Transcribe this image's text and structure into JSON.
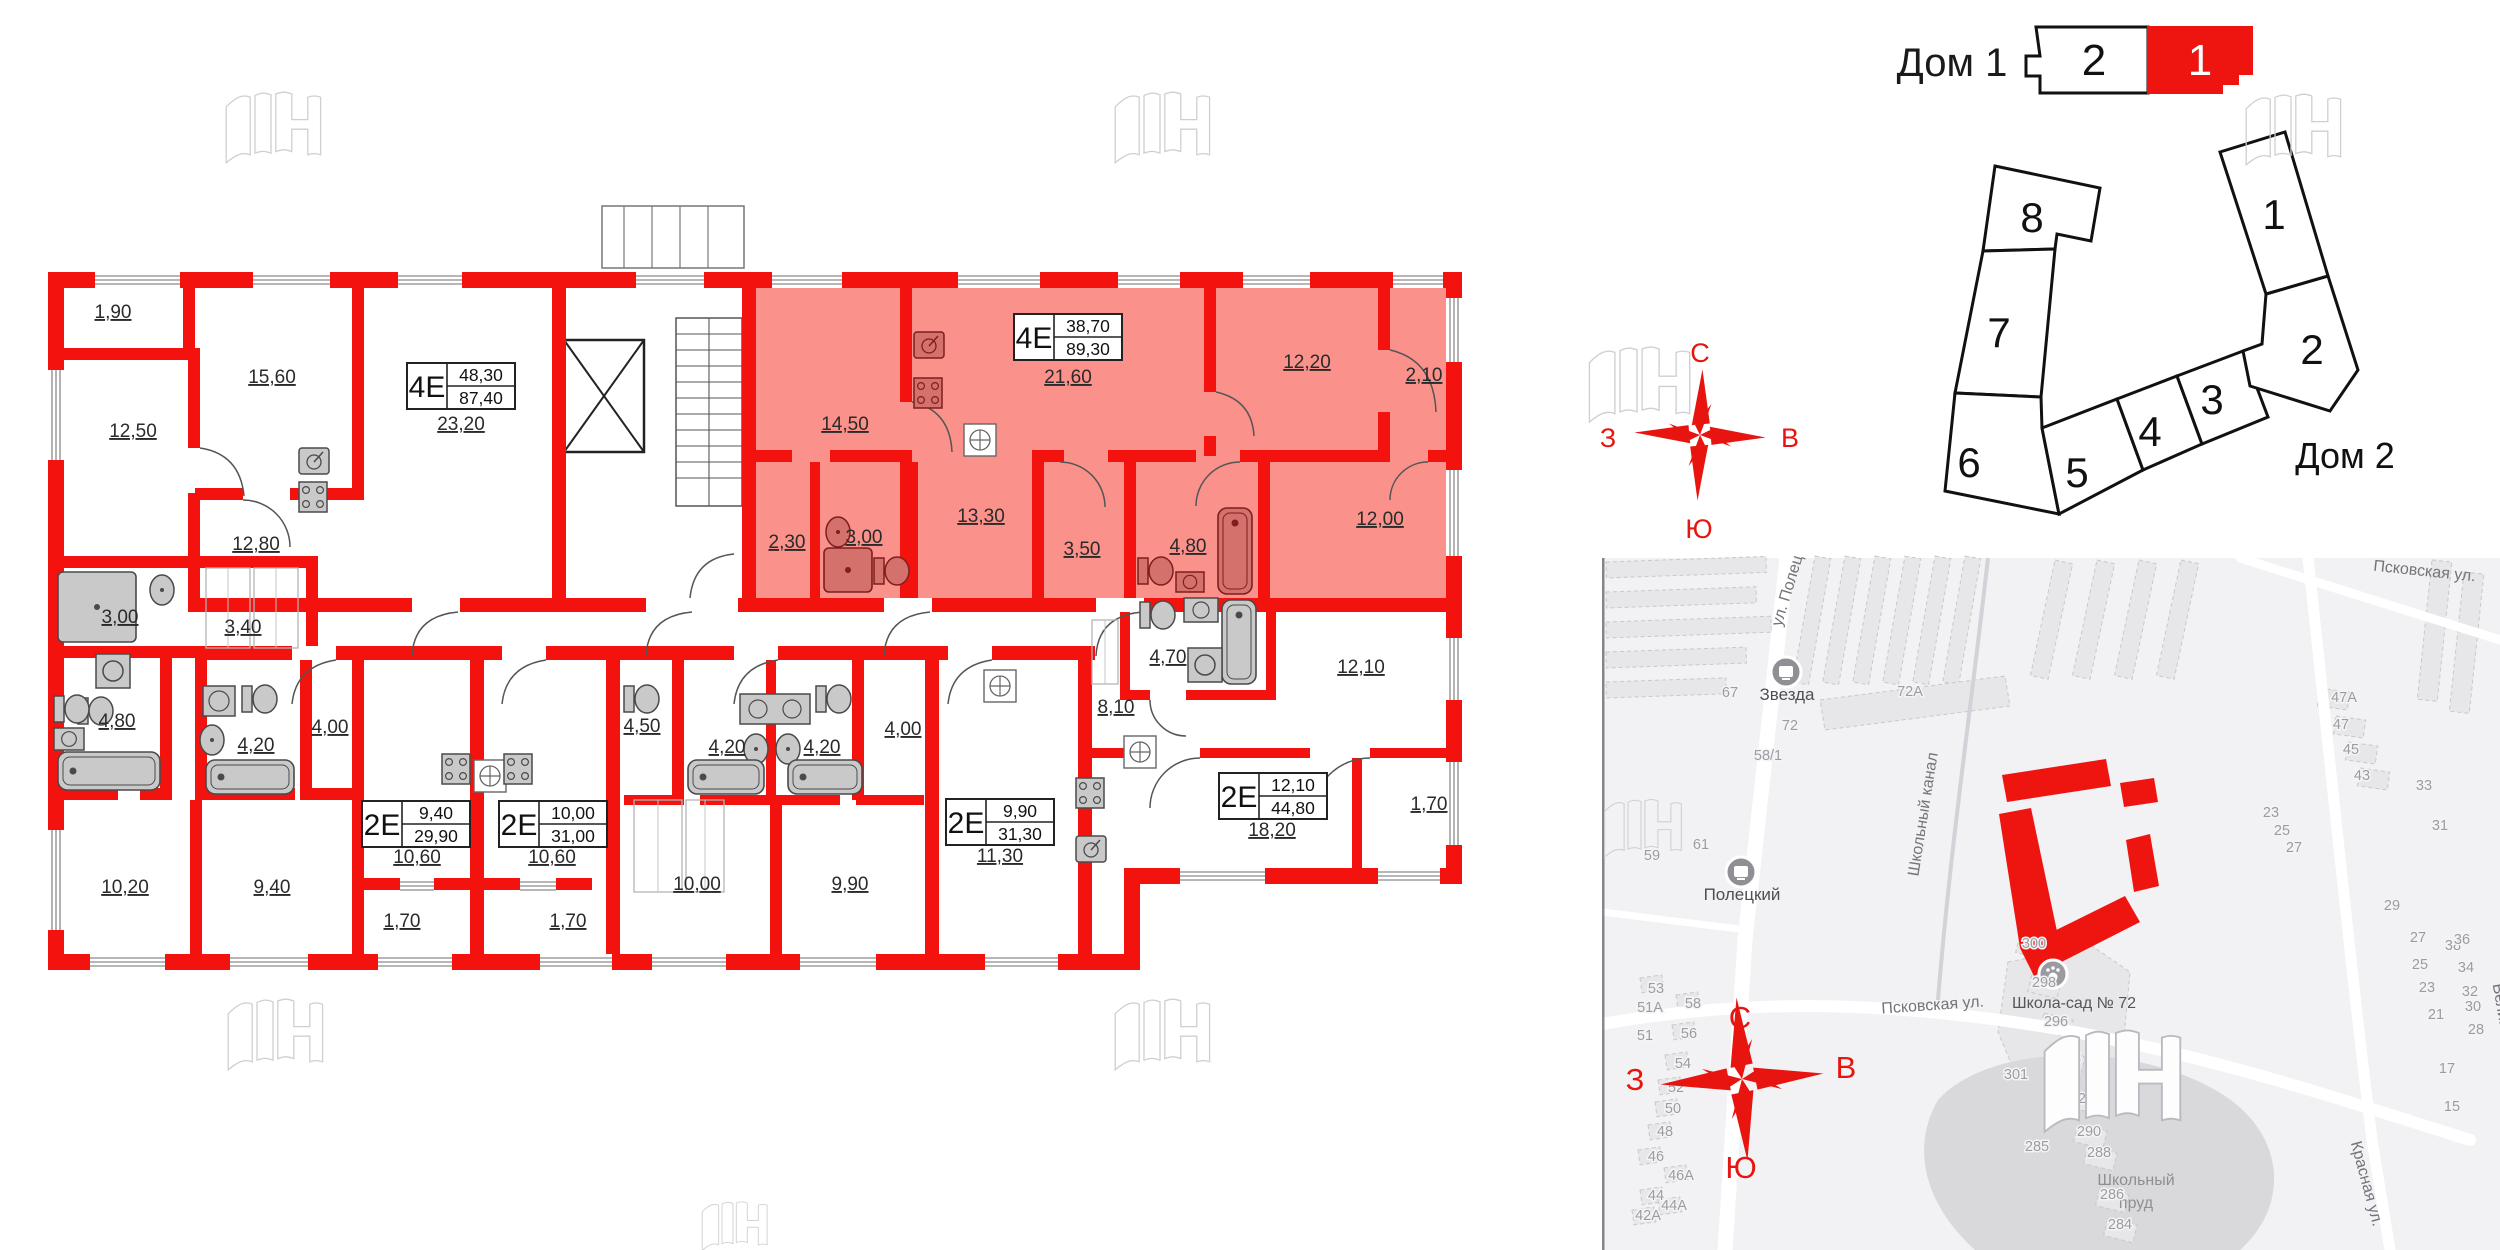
{
  "selector": {
    "title": "Дом 1",
    "tabs": [
      {
        "label": "2",
        "active": false
      },
      {
        "label": "1",
        "active": true
      }
    ],
    "active_color": "#ee1511"
  },
  "scheme": {
    "sections": [
      "8",
      "7",
      "6",
      "5",
      "4",
      "3",
      "2",
      "1"
    ],
    "house2": "Дом 2"
  },
  "compass": {
    "n": "С",
    "e": "В",
    "s": "Ю",
    "w": "З"
  },
  "floor_plan": {
    "highlight_color": "#fa918a",
    "wall_color": "#f3120e",
    "apartments": [
      {
        "type": "4Е",
        "area_living": "48,30",
        "area_total": "87,40",
        "x": 461,
        "y": 386,
        "highlighted": false
      },
      {
        "type": "4Е",
        "area_living": "38,70",
        "area_total": "89,30",
        "x": 1068,
        "y": 337,
        "highlighted": true
      },
      {
        "type": "2Е",
        "area_living": "9,40",
        "area_total": "29,90",
        "x": 416,
        "y": 824,
        "highlighted": false
      },
      {
        "type": "2Е",
        "area_living": "10,00",
        "area_total": "31,00",
        "x": 553,
        "y": 824,
        "highlighted": false
      },
      {
        "type": "2Е",
        "area_living": "9,90",
        "area_total": "31,30",
        "x": 1000,
        "y": 822,
        "highlighted": false
      },
      {
        "type": "2Е",
        "area_living": "12,10",
        "area_total": "44,80",
        "x": 1273,
        "y": 796,
        "highlighted": false
      }
    ],
    "rooms": [
      {
        "t": "1,90",
        "x": 113,
        "y": 318
      },
      {
        "t": "15,60",
        "x": 272,
        "y": 383
      },
      {
        "t": "12,50",
        "x": 133,
        "y": 437
      },
      {
        "t": "23,20",
        "x": 461,
        "y": 430
      },
      {
        "t": "12,80",
        "x": 256,
        "y": 550
      },
      {
        "t": "3,00",
        "x": 120,
        "y": 623
      },
      {
        "t": "3,40",
        "x": 243,
        "y": 633
      },
      {
        "t": "4,80",
        "x": 117,
        "y": 727
      },
      {
        "t": "4,20",
        "x": 256,
        "y": 751
      },
      {
        "t": "4,00",
        "x": 330,
        "y": 733
      },
      {
        "t": "10,20",
        "x": 125,
        "y": 893
      },
      {
        "t": "9,40",
        "x": 272,
        "y": 893
      },
      {
        "t": "14,50",
        "x": 845,
        "y": 430
      },
      {
        "t": "21,60",
        "x": 1068,
        "y": 383
      },
      {
        "t": "12,20",
        "x": 1307,
        "y": 368
      },
      {
        "t": "2,10",
        "x": 1424,
        "y": 381
      },
      {
        "t": "2,30",
        "x": 787,
        "y": 548
      },
      {
        "t": "3,00",
        "x": 864,
        "y": 543
      },
      {
        "t": "13,30",
        "x": 981,
        "y": 522
      },
      {
        "t": "3,50",
        "x": 1082,
        "y": 555
      },
      {
        "t": "4,80",
        "x": 1188,
        "y": 552
      },
      {
        "t": "12,00",
        "x": 1380,
        "y": 525
      },
      {
        "t": "10,60",
        "x": 417,
        "y": 863
      },
      {
        "t": "1,70",
        "x": 402,
        "y": 927
      },
      {
        "t": "10,60",
        "x": 552,
        "y": 863
      },
      {
        "t": "1,70",
        "x": 568,
        "y": 927
      },
      {
        "t": "4,50",
        "x": 642,
        "y": 732
      },
      {
        "t": "4,20",
        "x": 727,
        "y": 753
      },
      {
        "t": "4,20",
        "x": 822,
        "y": 753
      },
      {
        "t": "4,00",
        "x": 903,
        "y": 735
      },
      {
        "t": "10,00",
        "x": 697,
        "y": 890
      },
      {
        "t": "9,90",
        "x": 850,
        "y": 890
      },
      {
        "t": "11,30",
        "x": 1000,
        "y": 862
      },
      {
        "t": "8,10",
        "x": 1116,
        "y": 713
      },
      {
        "t": "4,70",
        "x": 1168,
        "y": 663
      },
      {
        "t": "12,10",
        "x": 1361,
        "y": 673
      },
      {
        "t": "18,20",
        "x": 1272,
        "y": 836
      },
      {
        "t": "1,70",
        "x": 1429,
        "y": 810
      }
    ]
  },
  "map": {
    "labels": [
      {
        "t": "ул. Полец",
        "x": 1792,
        "y": 592,
        "r": -73,
        "c": "mapst"
      },
      {
        "t": "Школьный канал",
        "x": 1928,
        "y": 815,
        "r": -81,
        "c": "mapst"
      },
      {
        "t": "Псковская ул.",
        "x": 1933,
        "y": 1010,
        "r": -4,
        "c": "mapst"
      },
      {
        "t": "Псковская ул.",
        "x": 2424,
        "y": 576,
        "r": 6,
        "c": "mapst"
      },
      {
        "t": "Красная ул.",
        "x": 2362,
        "y": 1185,
        "r": 75,
        "c": "mapst"
      },
      {
        "t": "Великая",
        "x": 2498,
        "y": 1015,
        "r": 80,
        "c": "mapst"
      },
      {
        "t": "Школа-сад № 72",
        "x": 2074,
        "y": 1008,
        "r": 0,
        "c": "poi"
      },
      {
        "t": "Школьный",
        "x": 2136,
        "y": 1185,
        "r": 0,
        "c": "pondlbl"
      },
      {
        "t": "пруд",
        "x": 2136,
        "y": 1208,
        "r": 0,
        "c": "pondlbl"
      }
    ],
    "stops": [
      {
        "name": "Звезда",
        "x": 1786,
        "y": 672,
        "lx": 1787,
        "ly": 700
      },
      {
        "name": "Полецкий",
        "x": 1741,
        "y": 872,
        "lx": 1742,
        "ly": 900
      }
    ],
    "numbers": [
      {
        "t": "67",
        "x": 1730,
        "y": 697
      },
      {
        "t": "72",
        "x": 1790,
        "y": 730
      },
      {
        "t": "58/1",
        "x": 1768,
        "y": 760
      },
      {
        "t": "61",
        "x": 1701,
        "y": 849
      },
      {
        "t": "59",
        "x": 1652,
        "y": 860
      },
      {
        "t": "72А",
        "x": 1910,
        "y": 696
      },
      {
        "t": "47А",
        "x": 2344,
        "y": 702
      },
      {
        "t": "47",
        "x": 2341,
        "y": 729
      },
      {
        "t": "45",
        "x": 2351,
        "y": 754
      },
      {
        "t": "43",
        "x": 2362,
        "y": 780
      },
      {
        "t": "23",
        "x": 2271,
        "y": 817
      },
      {
        "t": "25",
        "x": 2282,
        "y": 835
      },
      {
        "t": "27",
        "x": 2294,
        "y": 852
      },
      {
        "t": "33",
        "x": 2424,
        "y": 790
      },
      {
        "t": "31",
        "x": 2440,
        "y": 830
      },
      {
        "t": "29",
        "x": 2392,
        "y": 910
      },
      {
        "t": "38",
        "x": 2453,
        "y": 950
      },
      {
        "t": "27",
        "x": 2418,
        "y": 942
      },
      {
        "t": "25",
        "x": 2420,
        "y": 969
      },
      {
        "t": "23",
        "x": 2427,
        "y": 992
      },
      {
        "t": "21",
        "x": 2436,
        "y": 1019
      },
      {
        "t": "36",
        "x": 2462,
        "y": 944
      },
      {
        "t": "34",
        "x": 2466,
        "y": 972
      },
      {
        "t": "32",
        "x": 2470,
        "y": 996
      },
      {
        "t": "30",
        "x": 2473,
        "y": 1011
      },
      {
        "t": "28",
        "x": 2476,
        "y": 1034
      },
      {
        "t": "17",
        "x": 2447,
        "y": 1073
      },
      {
        "t": "15",
        "x": 2452,
        "y": 1111
      },
      {
        "t": "300",
        "x": 2034,
        "y": 948
      },
      {
        "t": "298",
        "x": 2044,
        "y": 987
      },
      {
        "t": "296",
        "x": 2056,
        "y": 1026
      },
      {
        "t": "294",
        "x": 2069,
        "y": 1063
      },
      {
        "t": "292",
        "x": 2090,
        "y": 1103
      },
      {
        "t": "290",
        "x": 2089,
        "y": 1136
      },
      {
        "t": "288",
        "x": 2099,
        "y": 1157
      },
      {
        "t": "286",
        "x": 2112,
        "y": 1199
      },
      {
        "t": "284",
        "x": 2120,
        "y": 1229
      },
      {
        "t": "285",
        "x": 2037,
        "y": 1151
      },
      {
        "t": "301",
        "x": 2016,
        "y": 1079
      },
      {
        "t": "53",
        "x": 1656,
        "y": 993
      },
      {
        "t": "51А",
        "x": 1650,
        "y": 1012
      },
      {
        "t": "51",
        "x": 1645,
        "y": 1040
      },
      {
        "t": "58",
        "x": 1693,
        "y": 1008
      },
      {
        "t": "56",
        "x": 1689,
        "y": 1038
      },
      {
        "t": "54",
        "x": 1683,
        "y": 1068
      },
      {
        "t": "52",
        "x": 1676,
        "y": 1092
      },
      {
        "t": "50",
        "x": 1673,
        "y": 1113
      },
      {
        "t": "48",
        "x": 1665,
        "y": 1136
      },
      {
        "t": "46",
        "x": 1656,
        "y": 1161
      },
      {
        "t": "46А",
        "x": 1681,
        "y": 1180
      },
      {
        "t": "44",
        "x": 1656,
        "y": 1200
      },
      {
        "t": "44А",
        "x": 1674,
        "y": 1210
      },
      {
        "t": "42А",
        "x": 1648,
        "y": 1220
      }
    ]
  }
}
